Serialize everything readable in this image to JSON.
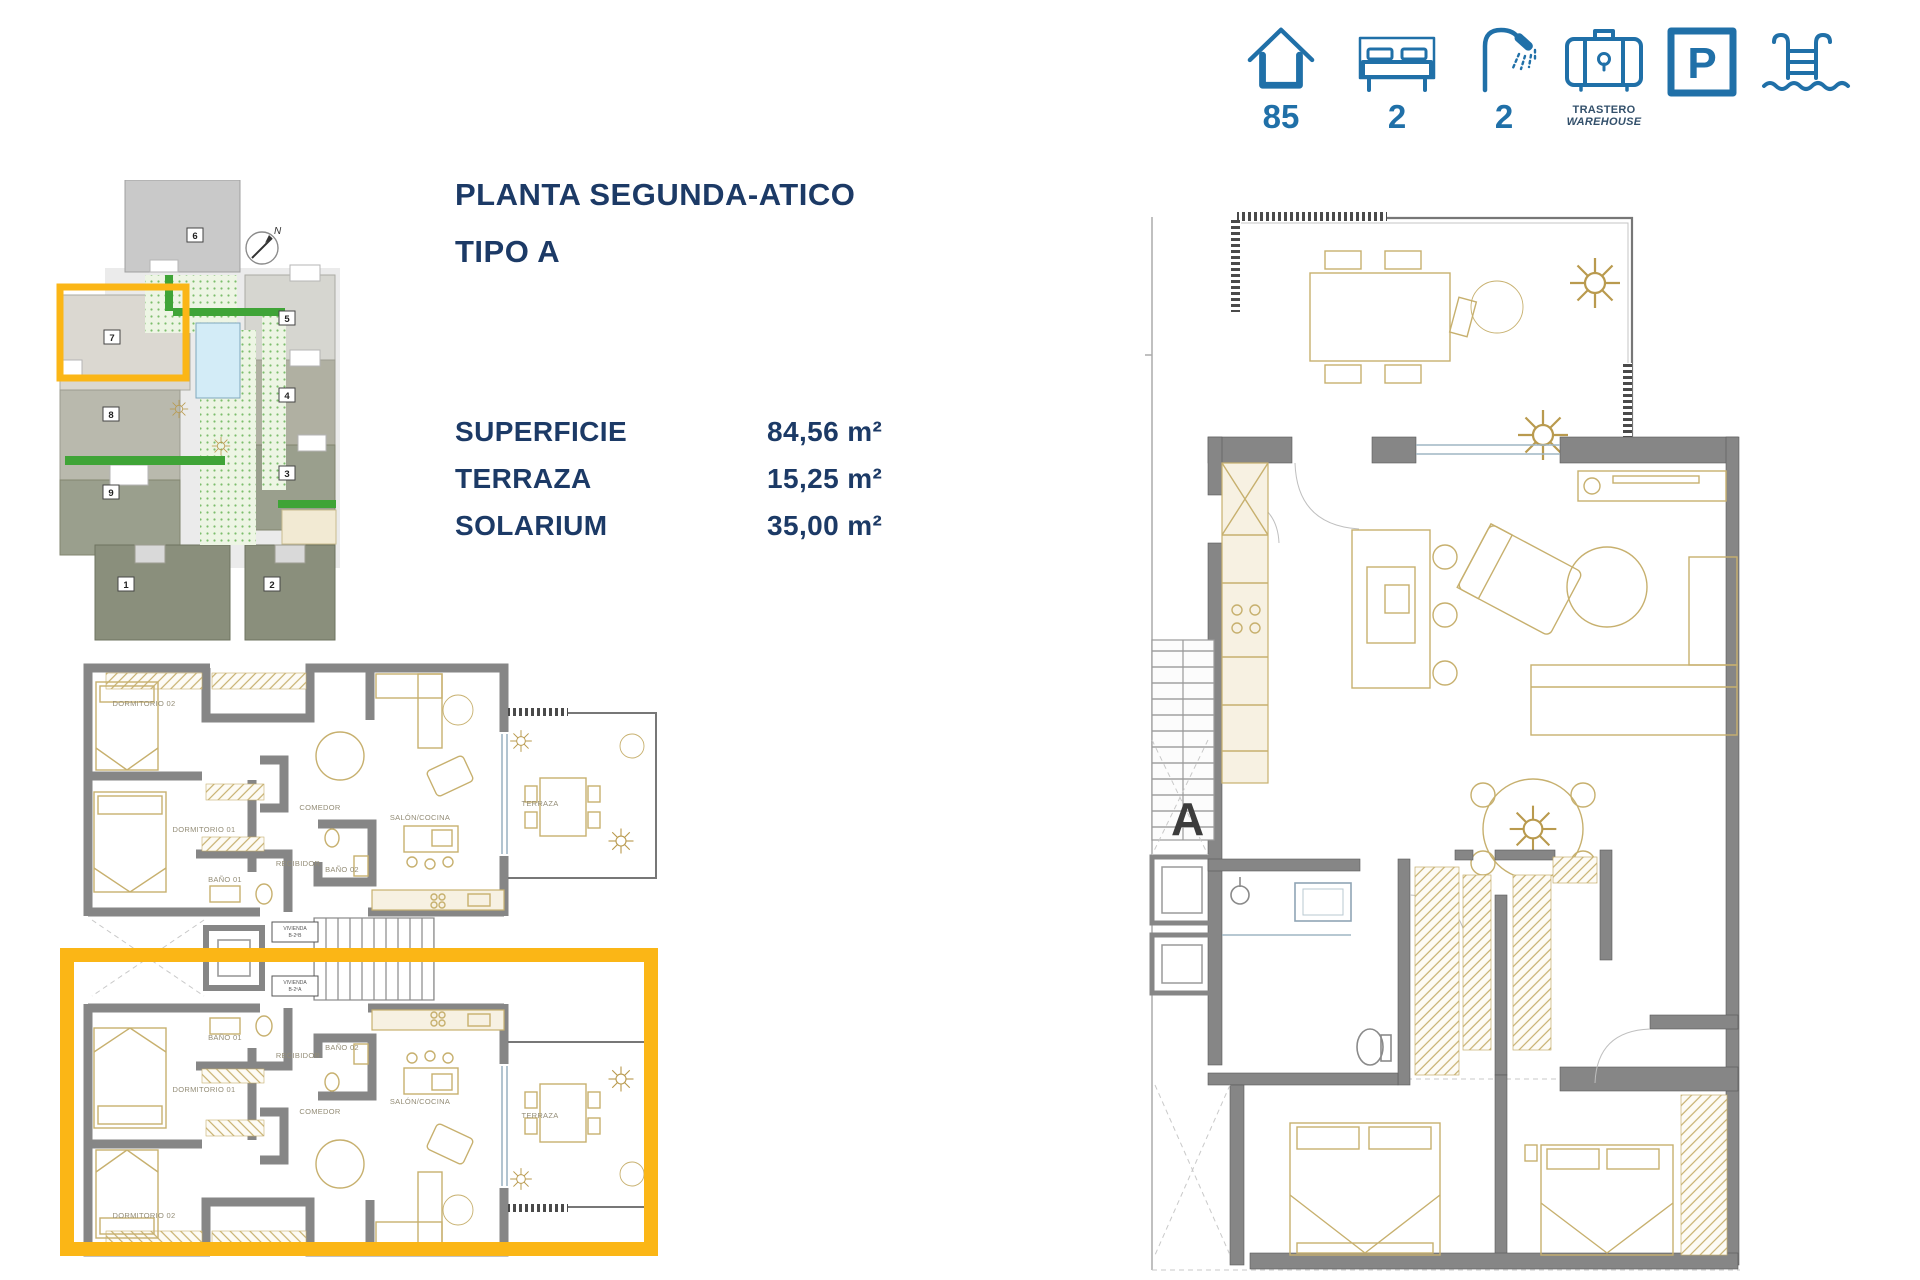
{
  "page": {
    "width": 1920,
    "height": 1280,
    "background": "#FFFFFF"
  },
  "header": {
    "title_line1": "PLANTA SEGUNDA-ATICO",
    "title_line2": "TIPO A"
  },
  "areas": {
    "rows": [
      {
        "label": "SUPERFICIE",
        "value": "84,56 m²"
      },
      {
        "label": "TERRAZA",
        "value": "15,25 m²"
      },
      {
        "label": "SOLARIUM",
        "value": "35,00 m²"
      }
    ]
  },
  "features": {
    "house": {
      "icon": "house-icon",
      "value": "85"
    },
    "bedrooms": {
      "icon": "bed-icon",
      "value": "2"
    },
    "bathrooms": {
      "icon": "shower-icon",
      "value": "2"
    },
    "storage": {
      "icon": "warehouse-icon",
      "label_es": "TRASTERO",
      "label_en": "WAREHOUSE"
    },
    "parking": {
      "icon": "parking-icon",
      "letter": "P"
    },
    "pool": {
      "icon": "pool-icon"
    }
  },
  "site_plan": {
    "north_label": "N",
    "blocks": [
      "1",
      "2",
      "3",
      "4",
      "5",
      "6",
      "7",
      "8",
      "9"
    ],
    "highlighted_block": "7"
  },
  "floor_plan_small": {
    "unit_top": {
      "rooms": {
        "dormitorio2": "DORMITORIO 02",
        "dormitorio1": "DORMITORIO 01",
        "bano1": "BAÑO 01",
        "bano2": "BAÑO 02",
        "recibidor": "RECIBIDOR",
        "comedor": "COMEDOR",
        "salon_cocina": "SALÓN/COCINA",
        "terraza": "TERRAZA"
      },
      "unit_tag_line1": "VIVIENDA",
      "unit_tag_line2": "B-2ºB"
    },
    "unit_bottom": {
      "rooms": {
        "dormitorio2": "DORMITORIO 02",
        "dormitorio1": "DORMITORIO 01",
        "bano1": "BAÑO 01",
        "bano2": "BAÑO 02",
        "recibidor": "RECIBIDOR",
        "comedor": "COMEDOR",
        "salon_cocina": "SALÓN/COCINA",
        "terraza": "TERRAZA"
      },
      "unit_tag_line1": "VIVIENDA",
      "unit_tag_line2": "B-2ºA"
    }
  },
  "floor_plan_large": {
    "section_label": "A"
  },
  "colors": {
    "accent_yellow": "#FBB616",
    "title_navy": "#1C3A66",
    "icon_blue": "#2070A8",
    "wall_gray": "#868686",
    "furniture_tan": "#C7B06E",
    "pool_blue": "#D3ECF7",
    "hedge_green": "#3FA437",
    "label_tan": "#938C76"
  }
}
